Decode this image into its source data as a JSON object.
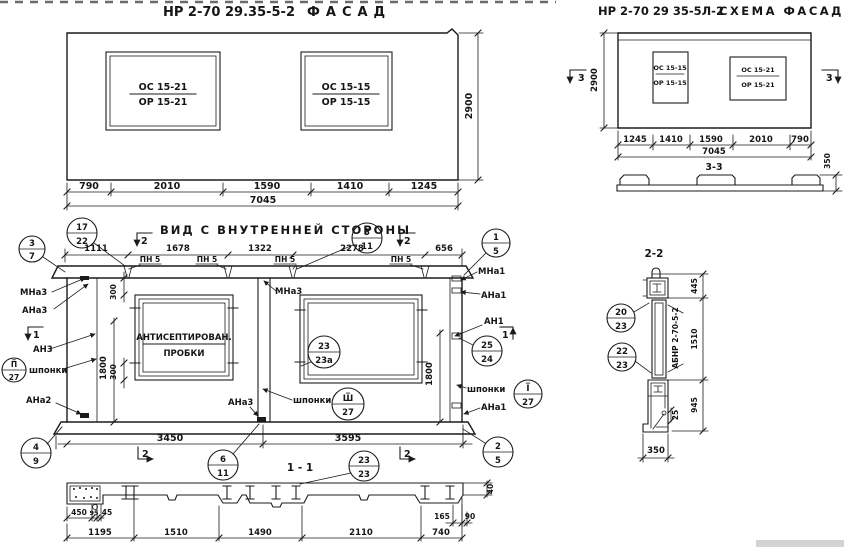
{
  "colors": {
    "ink": "#1b1b1b",
    "paper": "#ffffff"
  },
  "facade": {
    "code": "НР 2-70 29.35-5-2",
    "name": "ФАСАД",
    "window1": {
      "top": "ОС 15-21",
      "bottom": "ОР 15-21"
    },
    "window2": {
      "top": "ОС 15-15",
      "bottom": "ОР 15-15"
    },
    "height": "2900",
    "dims": [
      "790",
      "2010",
      "1590",
      "1410",
      "1245"
    ],
    "total": "7045"
  },
  "schema": {
    "code": "НР 2-70 29 35-5Л-2",
    "name": "СХЕМА ФАСАДА",
    "window1": {
      "top": "ОС 15-15",
      "bottom": "ОР 15-15"
    },
    "window2": {
      "top": "ОС 15-21",
      "bottom": "ОР 15-21"
    },
    "height": "2900",
    "dims": [
      "1245",
      "1410",
      "1590",
      "2010",
      "790"
    ],
    "total": "7045",
    "section_marker": "3",
    "section_label": "3-3",
    "profile_height": "350"
  },
  "inner": {
    "title": "ВИД С ВНУТРЕННЕЙ СТОРОНЫ",
    "top_dims": [
      "1111",
      "1678",
      "1322",
      "2278",
      "656"
    ],
    "pn_label": "ПН 5",
    "sec1": "1",
    "sec2": "2",
    "note_line1": "АНТИСЕПТИРОВАН.",
    "note_line2": "ПРОБКИ",
    "dim_300": "300",
    "dim_1800": "1800",
    "bottom_dims": [
      "3450",
      "3595"
    ],
    "labels_left": {
      "mna3": "МНа3",
      "ana3": "АНа3",
      "an3": "АН3",
      "shponki": "шпонки",
      "ana2": "АНа2"
    },
    "labels_right": {
      "mna1": "МНа1",
      "ana1": "АНа1",
      "an1": "АН1",
      "shponki": "шпонки",
      "ana1b": "АНа1"
    },
    "labels_mid": {
      "mna3": "МНа3",
      "ana3": "АНа3",
      "shponki": "шпонки"
    },
    "circles": {
      "c3_7": {
        "top": "3",
        "bottom": "7"
      },
      "c17_22": {
        "top": "17",
        "bottom": "22"
      },
      "c5_11": {
        "top": "5",
        "bottom": "11"
      },
      "c1_5": {
        "top": "1",
        "bottom": "5"
      },
      "cII_27": {
        "top": "П̅",
        "bottom": "27"
      },
      "cIII_27": {
        "top": "Ш̅",
        "bottom": "27"
      },
      "cI_27": {
        "top": "I̅",
        "bottom": "27"
      },
      "c25_24": {
        "top": "25",
        "bottom": "24"
      },
      "c23_23a": {
        "top": "23",
        "bottom": "23а"
      },
      "c4_9": {
        "top": "4",
        "bottom": "9"
      },
      "c6_11": {
        "top": "6",
        "bottom": "11"
      },
      "c2_5": {
        "top": "2",
        "bottom": "5"
      }
    }
  },
  "section1": {
    "label": "1 - 1",
    "circle": {
      "top": "23",
      "bottom": "23"
    },
    "dims_small": [
      "450",
      "95",
      "45"
    ],
    "dims": [
      "1195",
      "1510",
      "1490",
      "2110",
      "740"
    ],
    "dim_165": "165",
    "dim_90": "90",
    "dim_40": "40"
  },
  "section2": {
    "label": "2-2",
    "mark": "АБНР 2-70-5-2",
    "dim_445": "445",
    "dim_1510": "1510",
    "dim_945": "945",
    "dim_25": "25",
    "dim_350": "350",
    "circles": {
      "c20_23": {
        "top": "20",
        "bottom": "23"
      },
      "c22_23": {
        "top": "22",
        "bottom": "23"
      }
    }
  }
}
